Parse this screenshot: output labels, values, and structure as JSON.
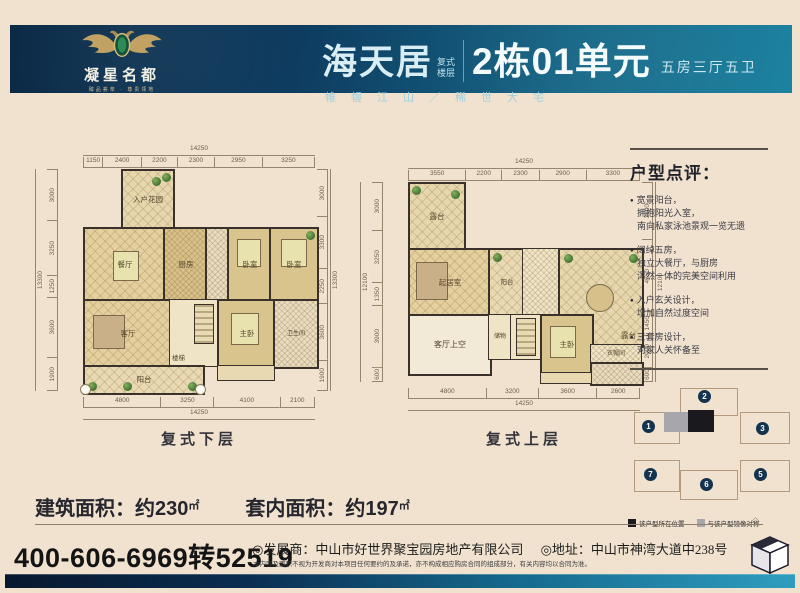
{
  "brand": {
    "name": "凝星名都",
    "tagline": "臻品荟萃 · 尊贵领地"
  },
  "header": {
    "project": "海天居",
    "tag_line1": "复式",
    "tag_line2": "楼层",
    "unit": "2栋01单元",
    "spec": "五房三厅五卫",
    "slogan": "帷幄江山／稀世大宅"
  },
  "plans": {
    "lower": {
      "caption": "复式下层",
      "dims": {
        "top_total": "14250",
        "top": [
          "1150",
          "2400",
          "2200",
          "2300",
          "2950",
          "3250"
        ],
        "bottom": [
          "4800",
          "3250",
          "4100",
          "2100"
        ],
        "bottom_total": "14250",
        "left": [
          "3000",
          "3250",
          "1250",
          "3600",
          "1900"
        ],
        "left_total": "13300",
        "right": [
          "3000",
          "3300",
          "2250",
          "3600",
          "1900"
        ],
        "right_total": "13300"
      },
      "rooms": {
        "entry_garden": "入户花园",
        "dining": "餐厅",
        "kitchen": "厨房",
        "bedroom1": "卧室",
        "bedroom2": "卧室",
        "living": "客厅",
        "stairs": "楼梯",
        "master": "主卧",
        "bath": "卫生间",
        "balcony": "阳台"
      }
    },
    "upper": {
      "caption": "复式上层",
      "dims": {
        "top_total": "14250",
        "top": [
          "3550",
          "2200",
          "2300",
          "2900",
          "3300"
        ],
        "bottom": [
          "4800",
          "3200",
          "3600",
          "2600"
        ],
        "bottom_total": "14250",
        "left": [
          "3000",
          "3250",
          "1350",
          "3900",
          "600"
        ],
        "left_total": "12100",
        "right": [
          "3600",
          "4550",
          "1450",
          "2000",
          "600"
        ],
        "right_total": "12100"
      },
      "rooms": {
        "terrace_left": "露台",
        "family": "起居室",
        "balcony": "阳台",
        "void": "客厅上空",
        "storage": "储物",
        "stairs": "楼梯",
        "master": "主卧",
        "closet": "衣帽间",
        "terrace_right": "露台"
      }
    }
  },
  "review": {
    "title": "户型点评：",
    "bullets": [
      {
        "lines": [
          "宽景阳台，",
          "拥抱阳光入室，",
          "南向私家泳池景观一览无遗"
        ]
      },
      {
        "lines": [
          "阔绰五房，",
          "独立大餐厅，与厨房",
          "浑然一体的完美空间利用"
        ]
      },
      {
        "lines": [
          "入户玄关设计，",
          "增加自然过度空间"
        ]
      },
      {
        "lines": [
          "三套房设计，",
          "对家人关怀备至"
        ]
      }
    ]
  },
  "areas": {
    "built_label": "建筑面积：",
    "built_value": "约230",
    "built_unit": "㎡",
    "inner_label": "套内面积：",
    "inner_value": "约197",
    "inner_unit": "㎡"
  },
  "siteplan": {
    "buildings": [
      "1",
      "2",
      "3",
      "7",
      "6",
      "5"
    ],
    "legend": [
      {
        "swatch": "#1a1a1e",
        "label": "该户型所在位置"
      },
      {
        "swatch": "#a6a6ac",
        "label": "与该户型镜像对称"
      }
    ]
  },
  "footer": {
    "phone": "400-606-6969转52519",
    "developer": "◎发展商：中山市好世界聚宝园房地产有限公司",
    "address": "◎地址：中山市神湾大道中238号",
    "disclaimer": "本内容及面积不视为开发商对本项目任何要约的及承诺，亦不构成相应购房合同的组成部分，有关内容均以合同为准。",
    "rule_ornament": "◇"
  },
  "colors": {
    "header_navy": "#0b2c4d",
    "header_teal": "#1b7e9c",
    "accent_gold": "#c2a264",
    "panel_bg": "#f2e5d2",
    "wall": "#3a322a"
  }
}
